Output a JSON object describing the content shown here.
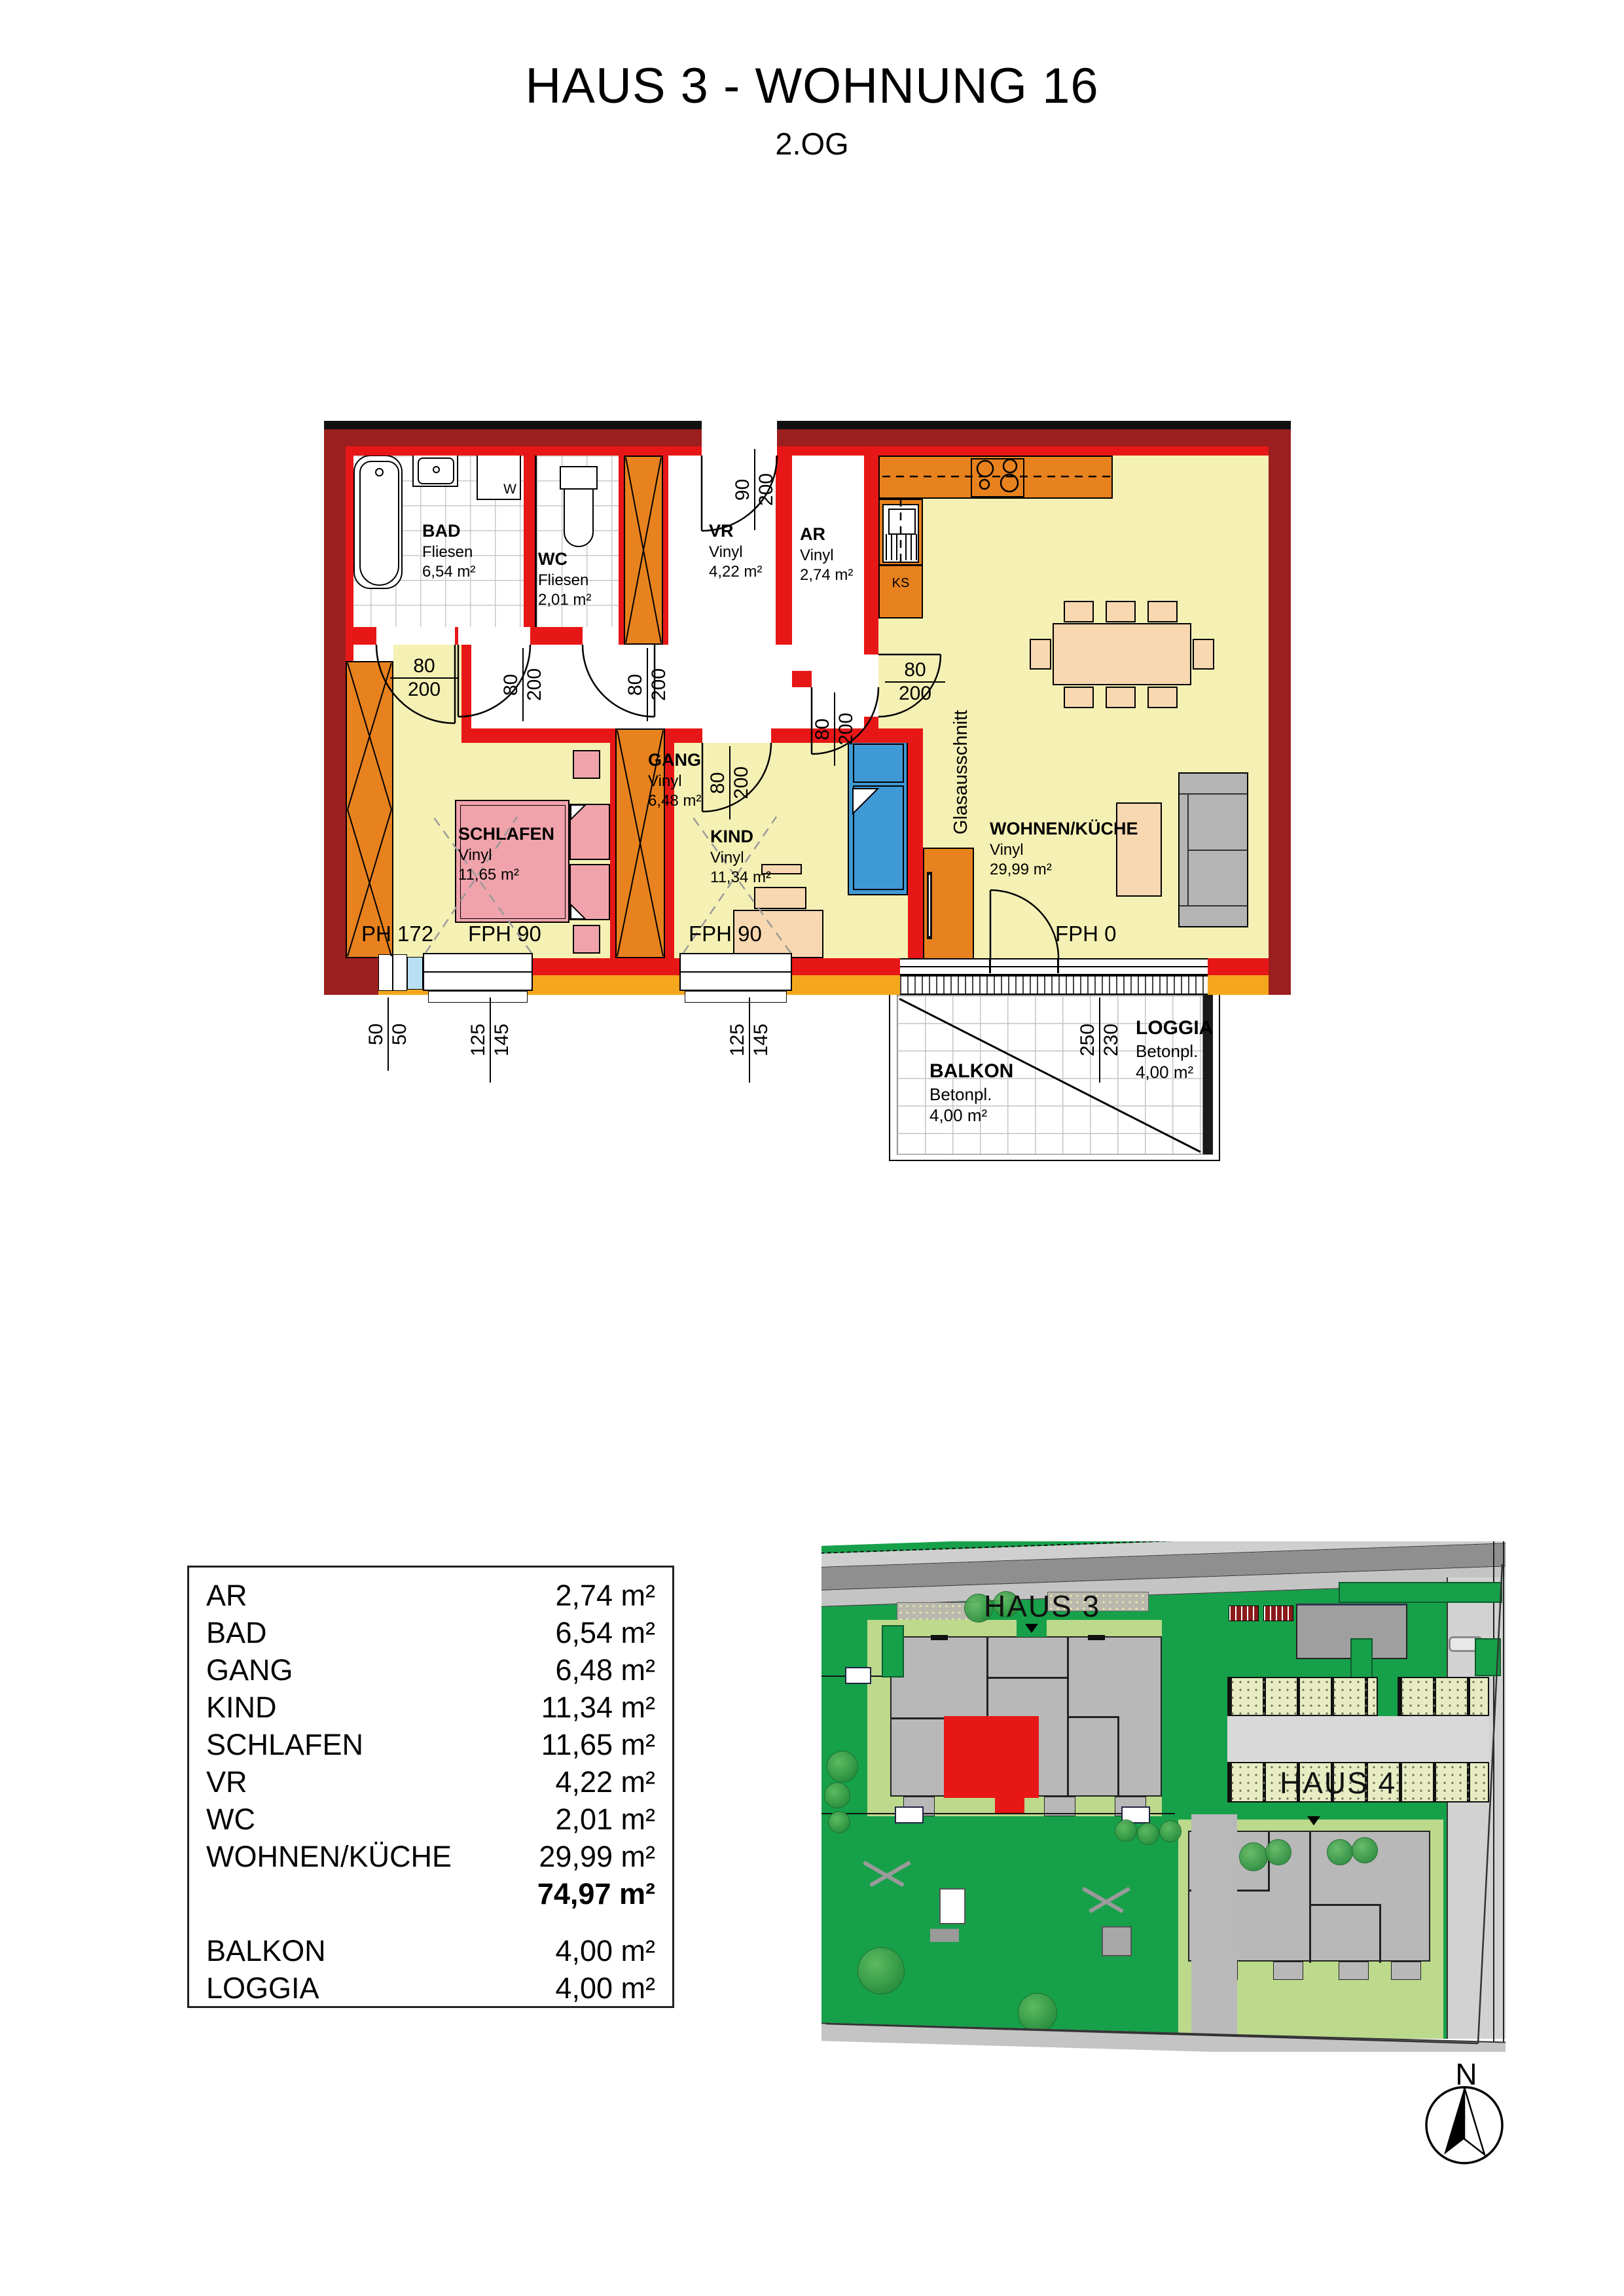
{
  "title": "HAUS 3 - WOHNUNG 16",
  "subtitle": "2.OG",
  "rooms": {
    "bad": {
      "name": "BAD",
      "floor": "Fliesen",
      "area": "6,54 m²"
    },
    "wc": {
      "name": "WC",
      "floor": "Fliesen",
      "area": "2,01 m²"
    },
    "vr": {
      "name": "VR",
      "floor": "Vinyl",
      "area": "4,22 m²"
    },
    "ar": {
      "name": "AR",
      "floor": "Vinyl",
      "area": "2,74 m²"
    },
    "gang": {
      "name": "GANG",
      "floor": "Vinyl",
      "area": "6,48 m²"
    },
    "schlafen": {
      "name": "SCHLAFEN",
      "floor": "Vinyl",
      "area": "11,65 m²"
    },
    "kind": {
      "name": "KIND",
      "floor": "Vinyl",
      "area": "11,34 m²"
    },
    "wohnen": {
      "name": "WOHNEN/KÜCHE",
      "floor": "Vinyl",
      "area": "29,99 m²"
    },
    "balkon": {
      "name": "BALKON",
      "floor": "Betonpl.",
      "area": "4,00 m²"
    },
    "loggia": {
      "name": "LOGGIA",
      "floor": "Betonpl.",
      "area": "4,00 m²"
    }
  },
  "dims": {
    "entrance": {
      "a": "90",
      "b": "200"
    },
    "door": {
      "a": "80",
      "b": "200"
    },
    "window": {
      "a": "125",
      "b": "145"
    },
    "niche": {
      "a": "50",
      "b": "50"
    },
    "balcony": {
      "a": "250",
      "b": "230"
    }
  },
  "annotations": {
    "glas": "Glasausschnitt",
    "ks": "KS",
    "w": "W",
    "ph172": "PH 172",
    "fph90": "FPH 90",
    "fph0": "FPH 0"
  },
  "area_table": {
    "rows": [
      {
        "label": "AR",
        "value": "2,74 m²"
      },
      {
        "label": "BAD",
        "value": "6,54 m²"
      },
      {
        "label": "GANG",
        "value": "6,48 m²"
      },
      {
        "label": "KIND",
        "value": "11,34 m²"
      },
      {
        "label": "SCHLAFEN",
        "value": "11,65 m²"
      },
      {
        "label": "VR",
        "value": "4,22 m²"
      },
      {
        "label": "WC",
        "value": "2,01 m²"
      },
      {
        "label": "WOHNEN/KÜCHE",
        "value": "29,99 m²"
      }
    ],
    "total": "74,97 m²",
    "extra": [
      {
        "label": "BALKON",
        "value": "4,00 m²"
      },
      {
        "label": "LOGGIA",
        "value": "4,00 m²"
      }
    ]
  },
  "site_plan": {
    "haus3": "HAUS 3",
    "haus4": "HAUS 4",
    "north": "N"
  },
  "colors": {
    "wall_outer": "#9b1f1f",
    "wall_inner": "#e81717",
    "wood_column": "#e8821e",
    "floor_yellow": "#f5f1b4",
    "sill_orange": "#f4a71c",
    "bed_pink": "#f0a3ab",
    "bed_blue": "#3f99d5",
    "furniture_peach": "#f8d8b0",
    "site_green": "#17a04a",
    "site_light_green": "#bcd98c",
    "highlight_unit_red": "#e81717"
  }
}
